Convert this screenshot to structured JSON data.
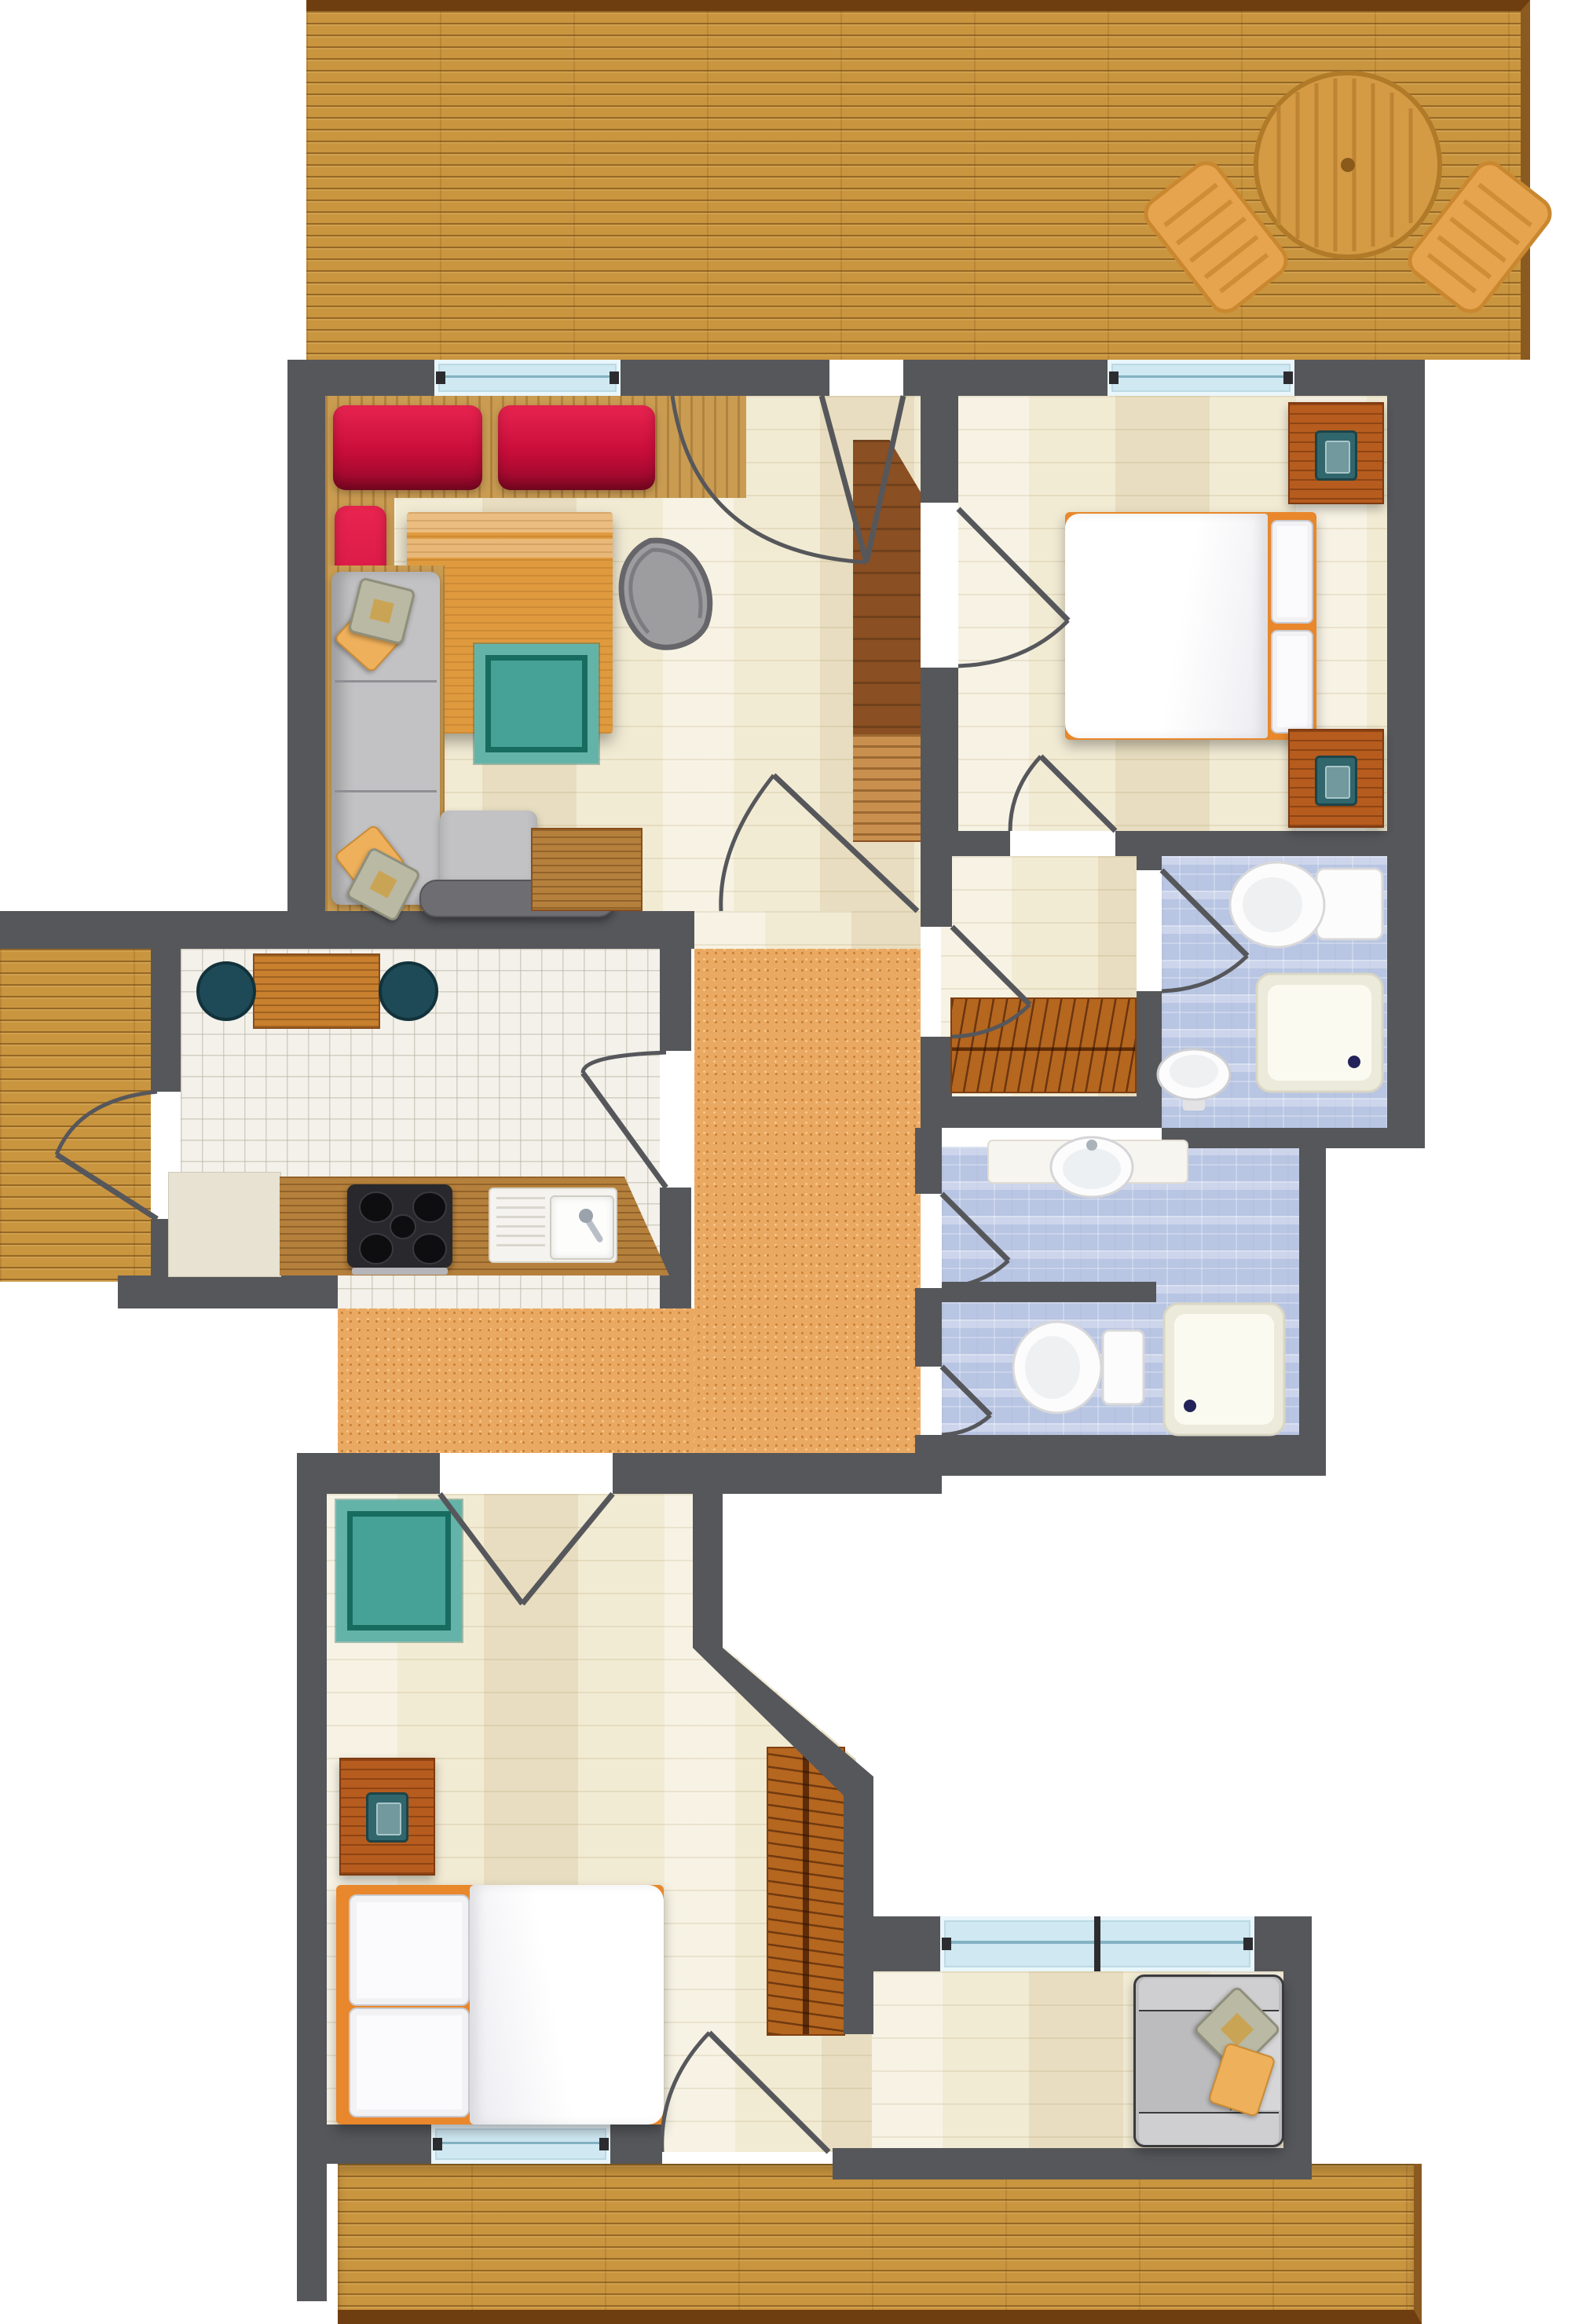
{
  "plan": {
    "type": "apartment-floor-plan-top-view",
    "visible_text": "",
    "colors": {
      "wall": "#56575b",
      "beige": "#f2ebd4",
      "tile": "#f3f1ea",
      "bath": "#b8c5e3",
      "hall": "#eaa963",
      "deck": "#c9953f",
      "deck-edge": "#6e3d10",
      "red": "#c80d3a",
      "wood": "#c99c52",
      "counter": "#b5803c",
      "furn": "#b65c1e",
      "rug-teal": "#46a296",
      "rug-border": "#176b5f",
      "lamp-teal": "#30666c",
      "gray-sofa": "#c2c2c4",
      "pillow-yellow": "#efb05b",
      "window-glass": "#cfe8f2",
      "fixture-white": "#fcfcfc",
      "stove-black": "#29292d",
      "stool-teal": "#1d4a56"
    },
    "areas": [
      {
        "id": "top-terrace",
        "kind": "terrace",
        "floor": "wood-deck",
        "furniture": [
          "round-table",
          "deck-chair-left",
          "deck-chair-right"
        ]
      },
      {
        "id": "living-room",
        "kind": "room",
        "floor": "light-parquet",
        "furniture": [
          "red-sofa-bench",
          "coffee-table",
          "egg-armchair",
          "teal-rug",
          "gray-corner-sofa",
          "sofa-bench-table",
          "side-table"
        ]
      },
      {
        "id": "entry-hall",
        "kind": "room",
        "floor": "light-parquet",
        "furniture": [
          "tall-wardrobe"
        ]
      },
      {
        "id": "bedroom-top",
        "kind": "bedroom",
        "floor": "light-parquet",
        "furniture": [
          "double-bed",
          "nightstand-with-lamp",
          "nightstand-with-lamp"
        ]
      },
      {
        "id": "vestibule",
        "kind": "corridor",
        "floor": "light-parquet",
        "furniture": [
          "hatched-closet"
        ]
      },
      {
        "id": "bathroom-top",
        "kind": "bathroom",
        "floor": "blue-mosaic",
        "furniture": [
          "toilet",
          "shower-tray",
          "pedestal-sink"
        ]
      },
      {
        "id": "kitchen",
        "kind": "kitchen",
        "floor": "white-tile",
        "furniture": [
          "dining-table",
          "round-stool",
          "round-stool",
          "base-cabinet",
          "counter-run",
          "stove-4-burner",
          "double-sink"
        ]
      },
      {
        "id": "hallway",
        "kind": "circulation",
        "floor": "orange-cobble",
        "furniture": []
      },
      {
        "id": "bathroom-bottom",
        "kind": "bathroom-split-wc",
        "floor": "blue-mosaic",
        "furniture": [
          "vanity-sink",
          "toilet",
          "shower-tray"
        ]
      },
      {
        "id": "bedroom-bottom",
        "kind": "bedroom",
        "floor": "light-parquet",
        "furniture": [
          "teal-rug",
          "nightstand-with-lamp",
          "double-bed",
          "hanger-wardrobe"
        ]
      },
      {
        "id": "lounge-nook",
        "kind": "room",
        "floor": "light-parquet",
        "furniture": [
          "gray-sofa-with-pillows"
        ]
      },
      {
        "id": "left-balcony",
        "kind": "terrace",
        "floor": "wood-deck",
        "furniture": []
      },
      {
        "id": "bottom-terrace",
        "kind": "terrace",
        "floor": "wood-deck",
        "furniture": []
      }
    ],
    "windows": [
      {
        "id": "window-living",
        "wall": "top",
        "panes": 1
      },
      {
        "id": "window-bedroom-top",
        "wall": "top",
        "panes": 1
      },
      {
        "id": "window-bedroom-bottom",
        "wall": "bottom",
        "panes": 1
      },
      {
        "id": "window-lounge",
        "wall": "lounge-top",
        "panes": 2
      }
    ],
    "doors": [
      {
        "id": "front-door",
        "between": [
          "top-terrace",
          "entry-hall"
        ],
        "style": "double-swing"
      },
      {
        "id": "door-living-hallway",
        "between": [
          "living-room",
          "hallway"
        ],
        "style": "swing"
      },
      {
        "id": "door-bedroom-top",
        "between": [
          "entry-hall",
          "bedroom-top"
        ],
        "style": "swing"
      },
      {
        "id": "door-bedroom-vestibule",
        "between": [
          "bedroom-top",
          "vestibule"
        ],
        "style": "swing"
      },
      {
        "id": "door-hall-vestibule",
        "between": [
          "hallway",
          "vestibule"
        ],
        "style": "swing"
      },
      {
        "id": "door-vestibule-bath",
        "between": [
          "vestibule",
          "bathroom-top"
        ],
        "style": "swing"
      },
      {
        "id": "door-kitchen",
        "between": [
          "hallway",
          "kitchen"
        ],
        "style": "swing"
      },
      {
        "id": "door-balcony-kitchen",
        "between": [
          "kitchen",
          "left-balcony"
        ],
        "style": "swing"
      },
      {
        "id": "door-bedroom-bottom",
        "between": [
          "hallway",
          "bedroom-bottom"
        ],
        "style": "double-swing"
      },
      {
        "id": "door-bath-bottom-sink",
        "between": [
          "hallway",
          "bathroom-bottom"
        ],
        "style": "swing"
      },
      {
        "id": "door-bath-bottom-wc",
        "between": [
          "hallway",
          "bathroom-bottom"
        ],
        "style": "swing"
      },
      {
        "id": "door-terrace-bedroom",
        "between": [
          "bedroom-bottom",
          "bottom-terrace"
        ],
        "style": "swing"
      }
    ]
  }
}
